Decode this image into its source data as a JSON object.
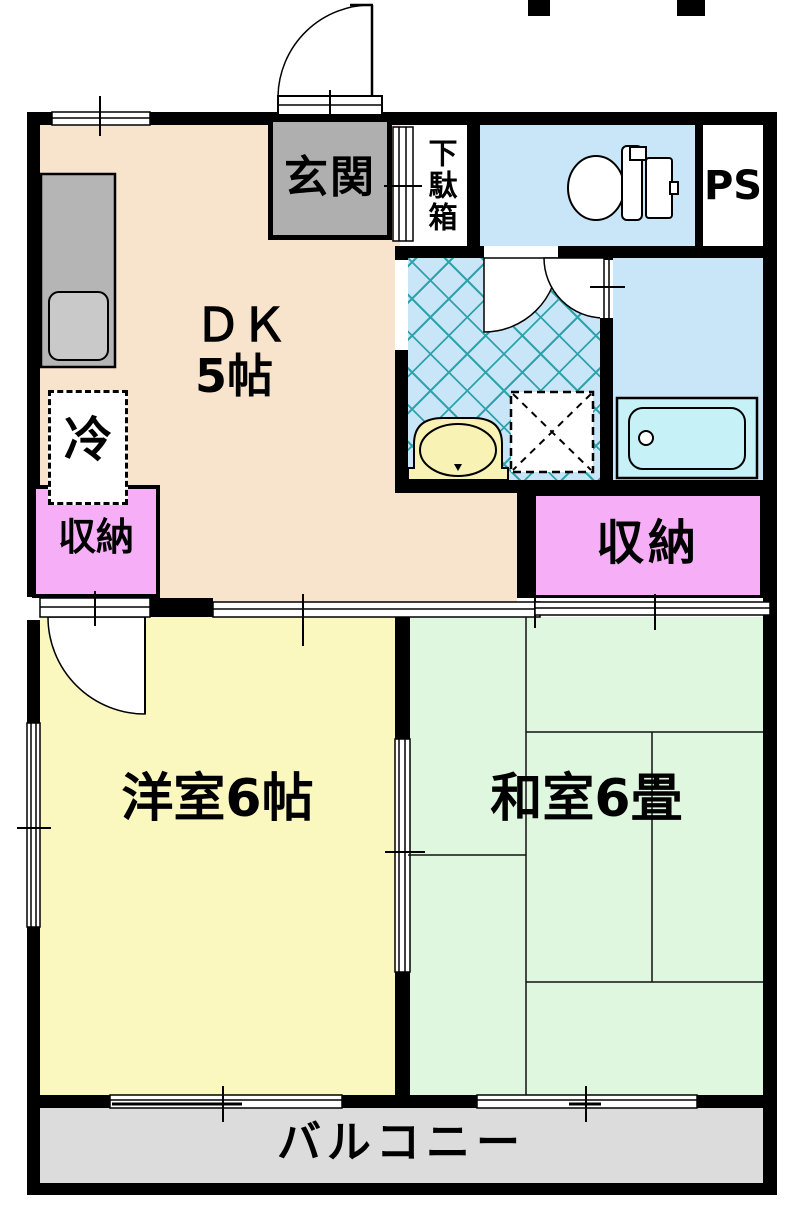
{
  "title": "apartment-floor-plan",
  "rooms": {
    "dk": {
      "label_line1": "ＤＫ",
      "label_line2": "5帖"
    },
    "genkan": {
      "label": "玄関"
    },
    "shoe_cabinet": {
      "label": "下駄箱"
    },
    "pipe_space": {
      "label": "PS"
    },
    "refrigerator": {
      "label": "冷"
    },
    "closet_left": {
      "label": "収納"
    },
    "closet_right": {
      "label": "収納"
    },
    "western_room": {
      "label": "洋室6帖"
    },
    "japanese_room": {
      "label": "和室6畳"
    },
    "balcony": {
      "label": "バルコニー"
    }
  },
  "fixtures": [
    "toilet-icon",
    "bathtub-icon",
    "washbasin-icon",
    "washing-machine-pan-icon",
    "kitchen-counter-icon",
    "kitchen-sink-icon",
    "door-swing-icon",
    "sliding-door-icon",
    "window-icon"
  ],
  "colors": {
    "bg": "#FFFFFF",
    "wall": "#000000",
    "dk_floor": "#F8E4CC",
    "western_floor": "#FAF7BF",
    "japanese_floor": "#DFF6DF",
    "closet": "#F6AFF6",
    "wet_area": "#C9E5F8",
    "hatch": "#2FA3AC",
    "balcony": "#DCDCDC",
    "genkan": "#AFAFAF",
    "counter": "#B5B5B5",
    "sink": "#C9C9C9",
    "tub": "#C6F1F7",
    "basin": "#F8F2B4"
  }
}
